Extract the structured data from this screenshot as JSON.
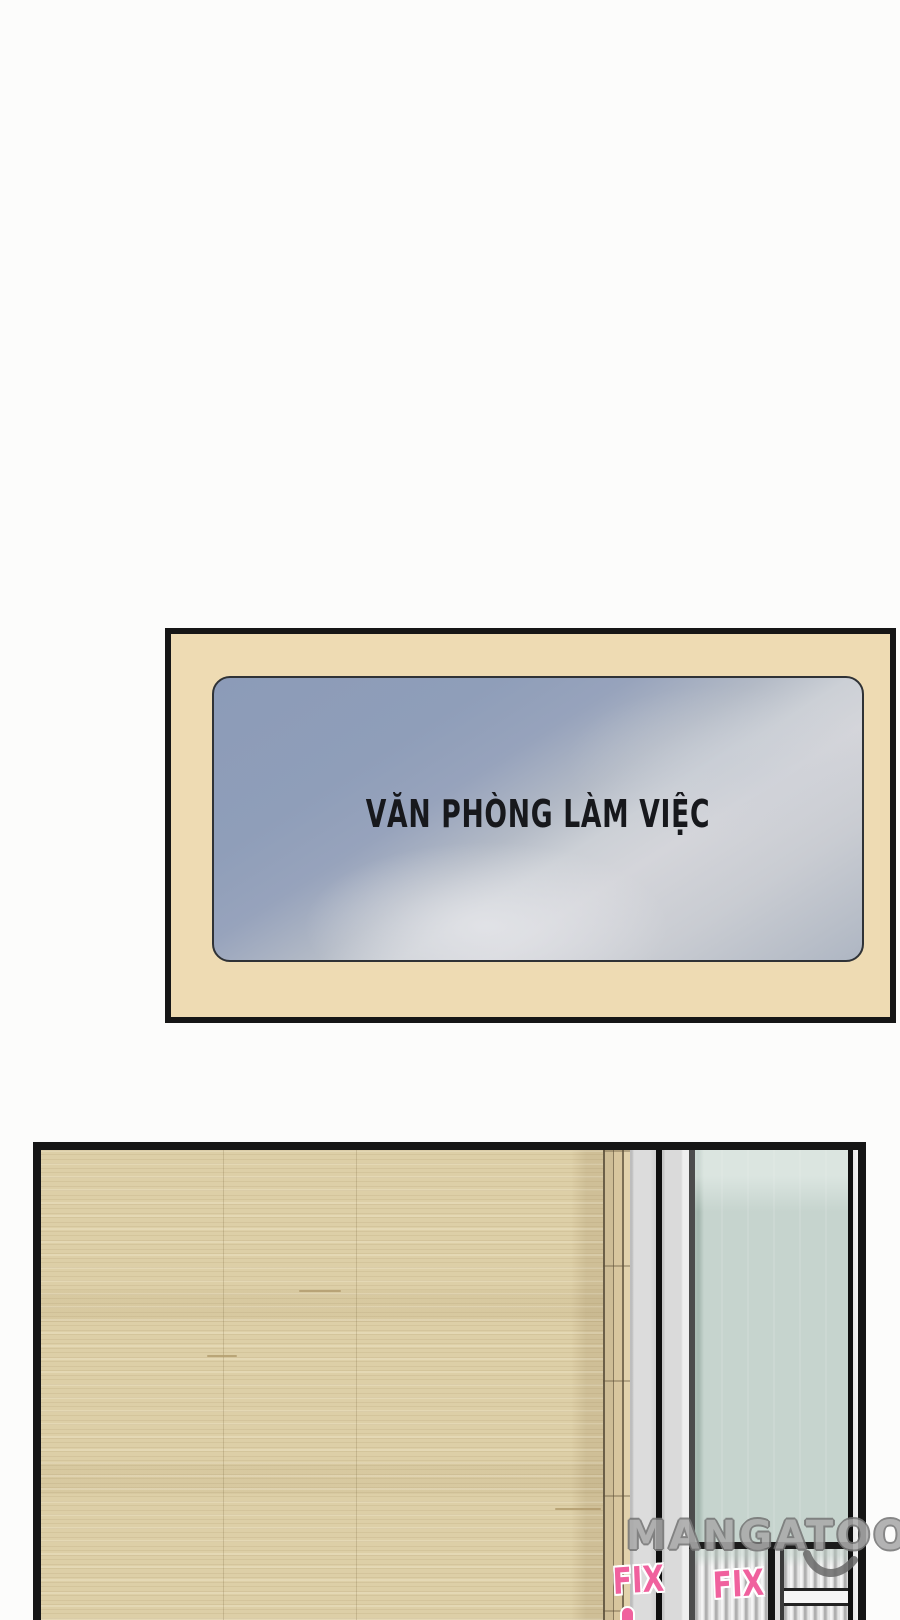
{
  "page": {
    "width": 900,
    "height": 1620,
    "background": "#fcfcfb"
  },
  "panels": {
    "office_sign_panel": {
      "background": "#eedbb3",
      "border_color": "#161616",
      "sign": {
        "label": "VĂN PHÒNG LÀM VIỆC",
        "plate_dark_color": "#8e9db9",
        "plate_light_color": "#d4d5da",
        "outline_color": "#2f3236",
        "text_color": "#17181c"
      }
    },
    "hallway_panel": {
      "border_color": "#161616",
      "wood_color": "#ddcfa7",
      "frame_gray_colors": [
        "#dadada",
        "#d6d6d6"
      ],
      "glass_color": "#c6d4ce",
      "shutter_color": "#d8d8d8",
      "fix_labels": [
        "FIX",
        "FIX"
      ],
      "fix_color": "#f0619e"
    }
  },
  "watermark": {
    "text": "MANGATOON",
    "fill": "#aaaaaa",
    "outline": "#767676"
  }
}
